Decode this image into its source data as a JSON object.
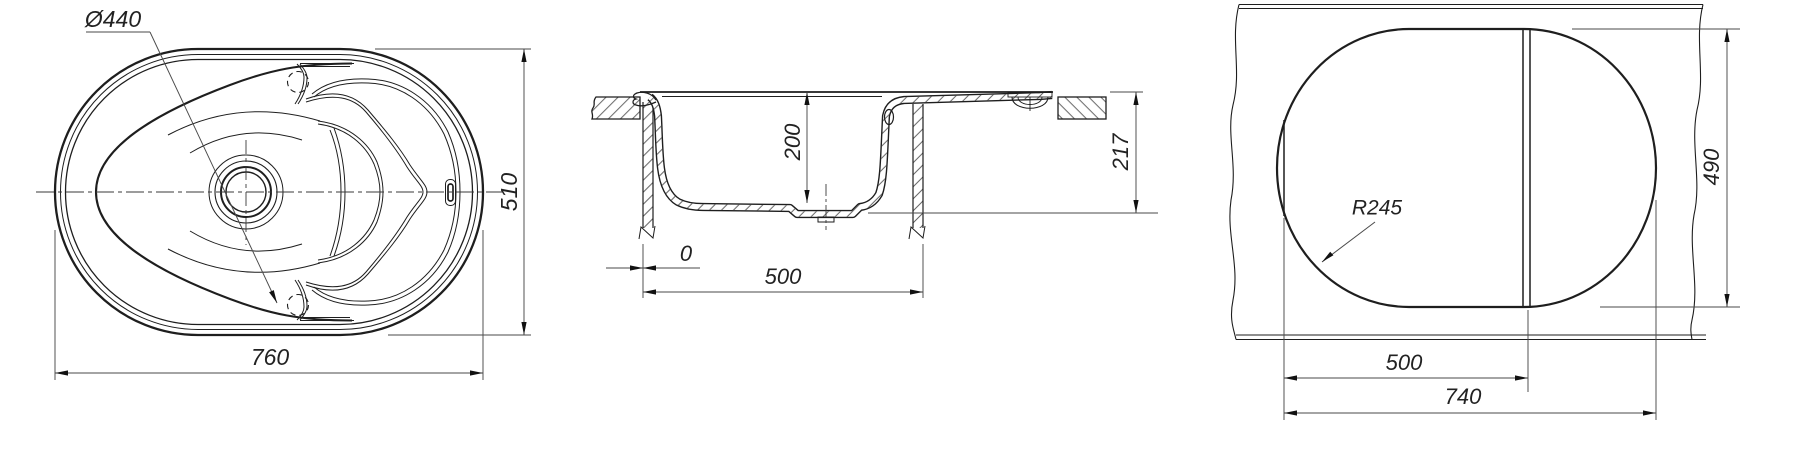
{
  "drawing": {
    "background": "#ffffff",
    "line_color": "#1e1e1e",
    "dim_color": "#444444",
    "views": {
      "top_view": {
        "dimensions": {
          "bowl_diameter": "Ø440",
          "overall_length": "760",
          "overall_width": "510"
        }
      },
      "section_view": {
        "dimensions": {
          "bowl_depth": "200",
          "overall_height": "217",
          "edge_offset": "0",
          "bowl_outer_width": "500"
        }
      },
      "cutout_view": {
        "dimensions": {
          "corner_radius": "R245",
          "cutout_height": "490",
          "bowl_section_width": "500",
          "cutout_length": "740"
        }
      }
    }
  }
}
